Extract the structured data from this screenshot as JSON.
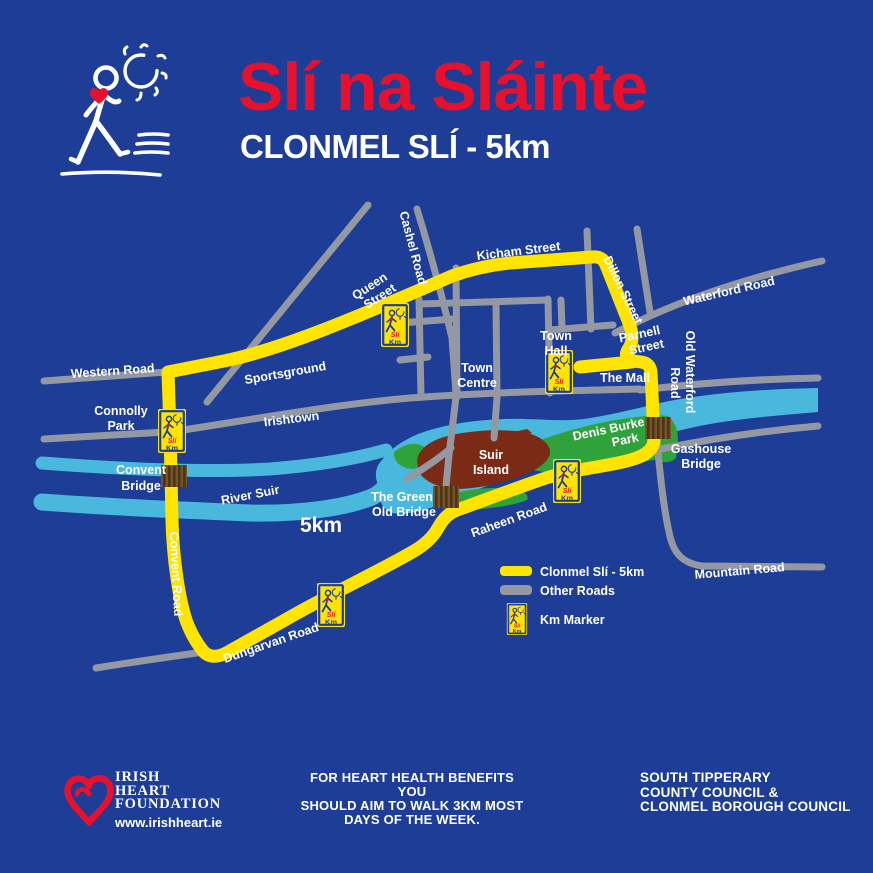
{
  "header": {
    "title": "Slí na Sláinte",
    "subtitle": "CLONMEL SLÍ - 5km"
  },
  "map": {
    "labels": {
      "western_road": "Western Road",
      "connolly_park_1": "Connolly",
      "connolly_park_2": "Park",
      "sportsground": "Sportsground",
      "irishtown": "Irishtown",
      "queen_street_1": "Queen",
      "queen_street_2": "Street",
      "cashel_road": "Cashel Road",
      "kicham_street": "Kicham Street",
      "dillon_street": "Dillon Street",
      "waterford_road": "Waterford Road",
      "old_waterford_1": "Old Waterford",
      "old_waterford_2": "Road",
      "town_hall_1": "Town",
      "town_hall_2": "Hall",
      "parnell_street_1": "Parnell",
      "parnell_street_2": "Street",
      "the_mall": "The Mall",
      "town_centre_1": "Town",
      "town_centre_2": "Centre",
      "denis_burke_1": "Denis Burke",
      "denis_burke_2": "Park",
      "gashouse_1": "Gashouse",
      "gashouse_2": "Bridge",
      "suir_island_1": "Suir",
      "suir_island_2": "Island",
      "river_suir": "River Suir",
      "green_old_bridge_1": "The Green",
      "green_old_bridge_2": "Old Bridge",
      "raheen_road": "Raheen Road",
      "mountain_road": "Mountain Road",
      "distance": "5km",
      "convent_road": "Convent Road",
      "dungarvan_road": "Dungarvan Road",
      "convent_bridge_1": "Convent",
      "convent_bridge_2": "Bridge"
    },
    "marker_sign": {
      "sli": "Slí",
      "km": "Km"
    },
    "legend": {
      "route_label": "Clonmel Slí - 5km",
      "other_roads_label": "Other Roads",
      "km_marker_label": "Km Marker"
    }
  },
  "footer": {
    "ihf_name_lines": [
      "IRISH",
      "HEART",
      "FOUNDATION"
    ],
    "ihf_url": "www.irishheart.ie",
    "message_lines": [
      "FOR HEART HEALTH BENEFITS YOU",
      "SHOULD AIM TO WALK 3KM MOST",
      "DAYS OF THE WEEK."
    ],
    "council_lines": [
      "SOUTH TIPPERARY",
      "COUNTY COUNCIL &",
      "CLONMEL BOROUGH COUNCIL"
    ]
  },
  "colors": {
    "background_blue": "#1d3d96",
    "route_yellow": "#ffe400",
    "road_grey": "#9498a2",
    "river_blue": "#4ab7dc",
    "park_green": "#2fa23c",
    "island_maroon": "#7b2a15",
    "bridge_brown": "#75552e",
    "bridge_stripe": "#4d3415",
    "accent_red": "#e8112d",
    "text_white": "#ffffff"
  }
}
